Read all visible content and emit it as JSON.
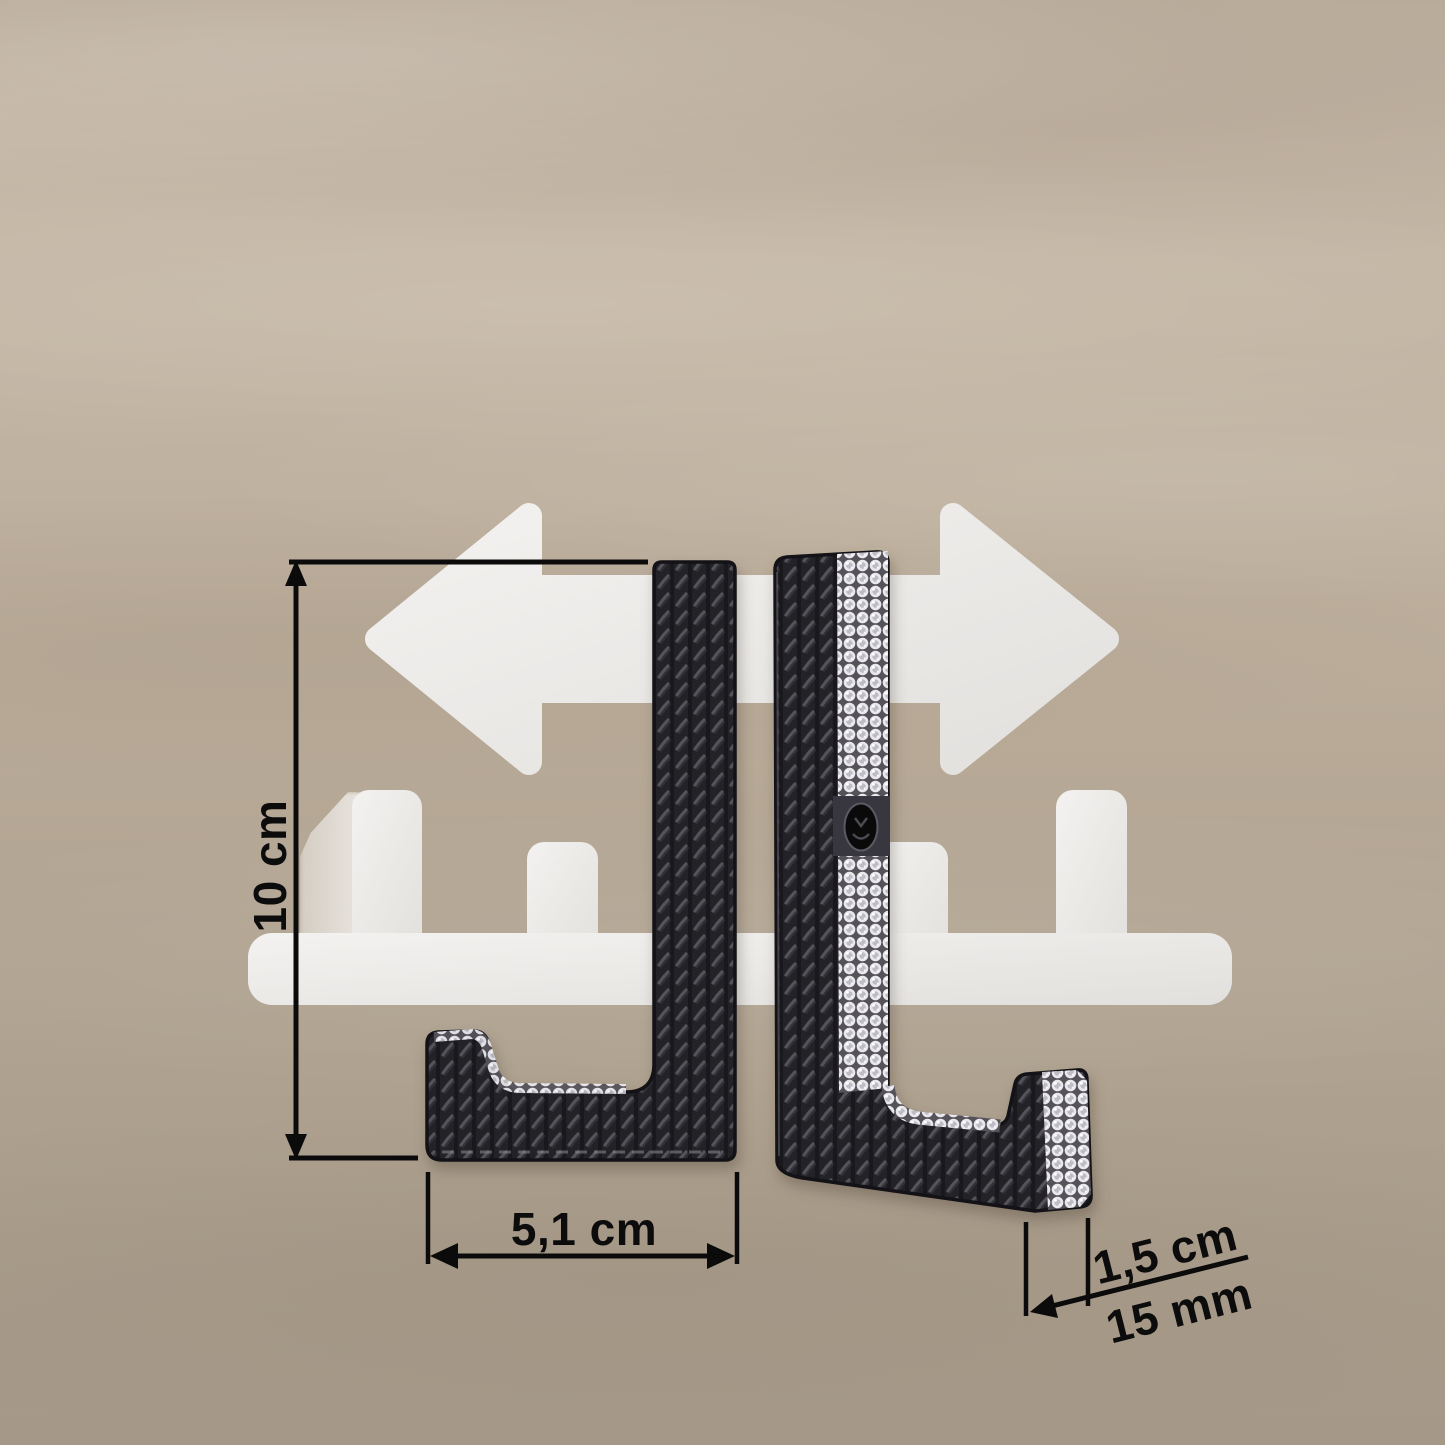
{
  "canvas": {
    "width": 1445,
    "height": 1445
  },
  "annotations": {
    "height_label": "10 cm",
    "width_label": "5,1 cm",
    "depth_label_cm": "1,5 cm",
    "depth_label_mm": "15 mm"
  },
  "icons": {
    "double_arrow": "left-right-arrow-icon",
    "rack": "wall-rack-silhouette-icon",
    "left_hook": "door-hook-front-image",
    "right_hook": "door-hook-side-rhinestone-image",
    "emblem": "oval-emblem-icon"
  },
  "colors": {
    "background_taupe": "#b9ab9a",
    "silhouette_white": "#eceae7",
    "dimension_black": "#0b0b0b",
    "hook_black": "#232227",
    "rhinestone_silver": "#e9e8ec"
  }
}
